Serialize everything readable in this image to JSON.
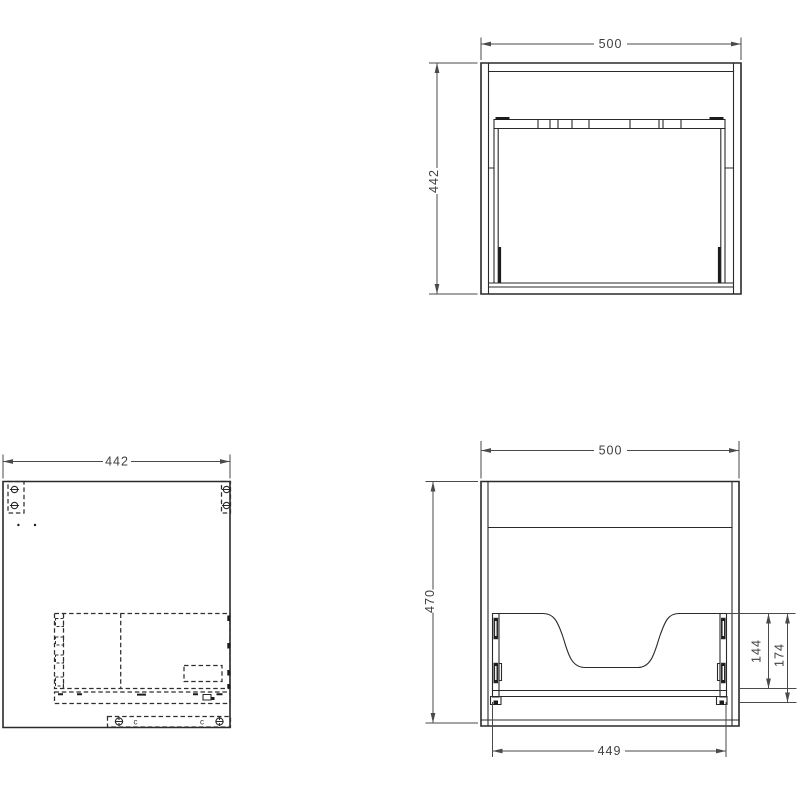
{
  "views": {
    "top": {
      "width": "500",
      "depth": "442"
    },
    "side": {
      "depth": "442",
      "letter_left": "c",
      "letter_right": "c"
    },
    "front": {
      "width": "500",
      "height": "470",
      "bottom_width": "449",
      "cutout_height": "144",
      "panel_height": "174"
    }
  },
  "colors": {
    "object_line": "#2a2a2a",
    "dimension_line": "#4a4a4a",
    "label_text": "#3f3f3f",
    "background": "#ffffff"
  }
}
